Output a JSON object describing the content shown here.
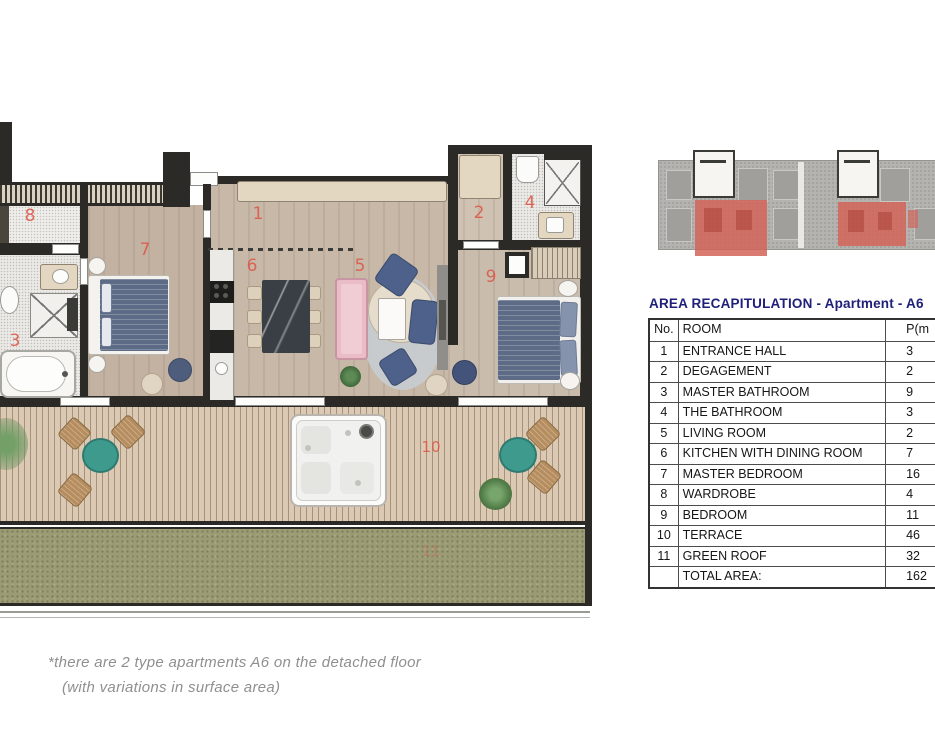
{
  "plan": {
    "room_labels": [
      "1",
      "2",
      "3",
      "4",
      "5",
      "6",
      "7",
      "8",
      "9",
      "10",
      "11"
    ]
  },
  "table": {
    "title": "AREA RECAPITULATION - Apartment - A6",
    "columns": {
      "no": "No.",
      "room": "ROOM",
      "p": "P(m"
    },
    "rows": [
      {
        "no": "1",
        "room": "ENTRANCE HALL",
        "p": "3"
      },
      {
        "no": "2",
        "room": "DEGAGEMENT",
        "p": "2"
      },
      {
        "no": "3",
        "room": "MASTER BATHROOM",
        "p": "9"
      },
      {
        "no": "4",
        "room": "THE BATHROOM",
        "p": "3"
      },
      {
        "no": "5",
        "room": "LIVING ROOM",
        "p": "2"
      },
      {
        "no": "6",
        "room": "KITCHEN WITH DINING ROOM",
        "p": "7"
      },
      {
        "no": "7",
        "room": "MASTER BEDROOM",
        "p": "16"
      },
      {
        "no": "8",
        "room": "WARDROBE",
        "p": "4"
      },
      {
        "no": "9",
        "room": "BEDROOM",
        "p": "11"
      },
      {
        "no": "10",
        "room": "TERRACE",
        "p": "46"
      },
      {
        "no": "11",
        "room": "GREEN ROOF",
        "p": "32"
      }
    ],
    "total": {
      "no": "",
      "label": "TOTAL AREA:",
      "p": "162"
    }
  },
  "footnote": {
    "line1": "*there are 2 type apartments A6 on the detached floor",
    "line2": "(with variations in surface area)"
  },
  "colors": {
    "label_red": "#dc5a4b",
    "title_navy": "#20207a",
    "highlight_red": "#d26458",
    "deck_wood": "#dbc9b3",
    "green_roof": "#9b9b74",
    "wall_dark": "#2b2a27"
  }
}
